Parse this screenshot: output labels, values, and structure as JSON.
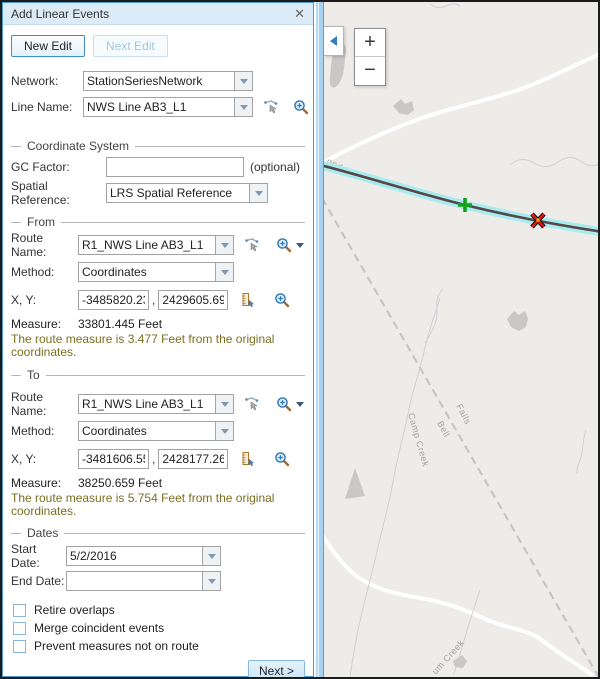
{
  "colors": {
    "panel_border": "#4d9ad4",
    "titlebar_bg": "#dcebf8",
    "accent_blue": "#3f8dc6",
    "hint_text": "#7a7020",
    "route_highlight": "#a7ecef",
    "route_line": "#5a4646",
    "from_marker_green": "#14a21a",
    "to_marker_red": "#e01515",
    "map_background": "#eeece9"
  },
  "panel": {
    "title": "Add Linear Events",
    "close_icon": "✕",
    "buttons": {
      "new_edit": "New Edit",
      "next_edit": "Next Edit"
    },
    "network": {
      "label": "Network:",
      "value": "StationSeriesNetwork"
    },
    "line_name": {
      "label": "Line Name:",
      "value": "NWS Line AB3_L1"
    },
    "coordinate_system": {
      "section_label": "Coordinate System",
      "gc_factor_label": "GC Factor:",
      "gc_factor_value": "",
      "optional_hint": "(optional)",
      "spatial_reference_label": "Spatial Reference:",
      "spatial_reference_value": "LRS Spatial Reference"
    },
    "from": {
      "section_label": "From",
      "route_name_label": "Route Name:",
      "route_name_value": "R1_NWS Line AB3_L1",
      "method_label": "Method:",
      "method_value": "Coordinates",
      "xy_label": "X, Y:",
      "x_value": "-3485820.236",
      "y_value": "2429605.69",
      "separator": ",",
      "measure_label": "Measure:",
      "measure_value": "33801.445 Feet",
      "hint": "The route measure is 3.477 Feet from the original coordinates."
    },
    "to": {
      "section_label": "To",
      "route_name_label": "Route Name:",
      "route_name_value": "R1_NWS Line AB3_L1",
      "method_label": "Method:",
      "method_value": "Coordinates",
      "xy_label": "X, Y:",
      "x_value": "-3481606.551",
      "y_value": "2428177.26",
      "separator": ",",
      "measure_label": "Measure:",
      "measure_value": "38250.659 Feet",
      "hint": "The route measure is 5.754 Feet from the original coordinates."
    },
    "dates": {
      "section_label": "Dates",
      "start_date_label": "Start Date:",
      "start_date_value": "5/2/2016",
      "end_date_label": "End Date:",
      "end_date_value": ""
    },
    "checkboxes": [
      {
        "label": "Retire overlaps",
        "checked": false
      },
      {
        "label": "Merge coincident events",
        "checked": false
      },
      {
        "label": "Prevent measures not on route",
        "checked": false
      }
    ],
    "next_button": "Next >"
  },
  "map": {
    "zoom_in": "+",
    "zoom_out": "−",
    "labels": {
      "road": "ond Cr",
      "rail_1": "Falls",
      "rail_2": "Bell",
      "creek_left": "Camp Creek",
      "creek_bottom": "um Creek"
    }
  }
}
